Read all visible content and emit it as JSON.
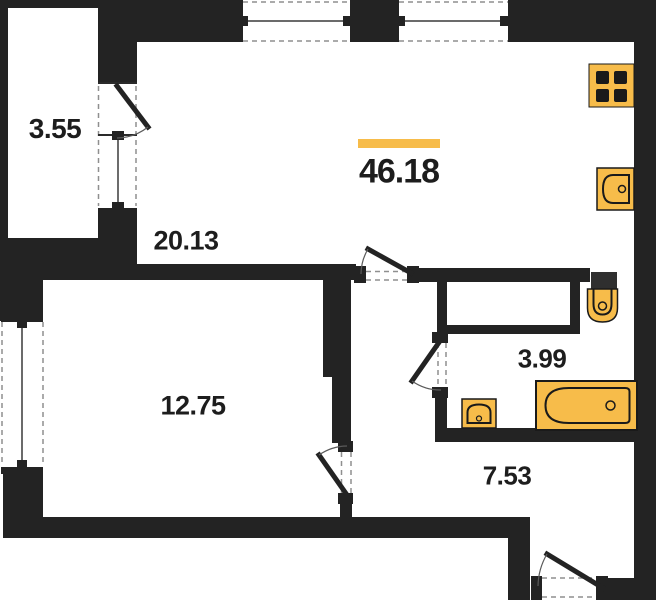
{
  "colors": {
    "accent": "#F7BC4A",
    "wall": "#232323",
    "dash": "#8f8f8f"
  },
  "total": {
    "area": "46.18"
  },
  "rooms": {
    "balcony": {
      "area": "3.55"
    },
    "living": {
      "area": "20.13"
    },
    "bedroom": {
      "area": "12.75"
    },
    "bathroom": {
      "area": "3.99"
    },
    "hallway": {
      "area": "7.53"
    }
  },
  "fixtures": [
    "stove",
    "kitchen-sink",
    "toilet",
    "washbasin",
    "bathtub"
  ]
}
